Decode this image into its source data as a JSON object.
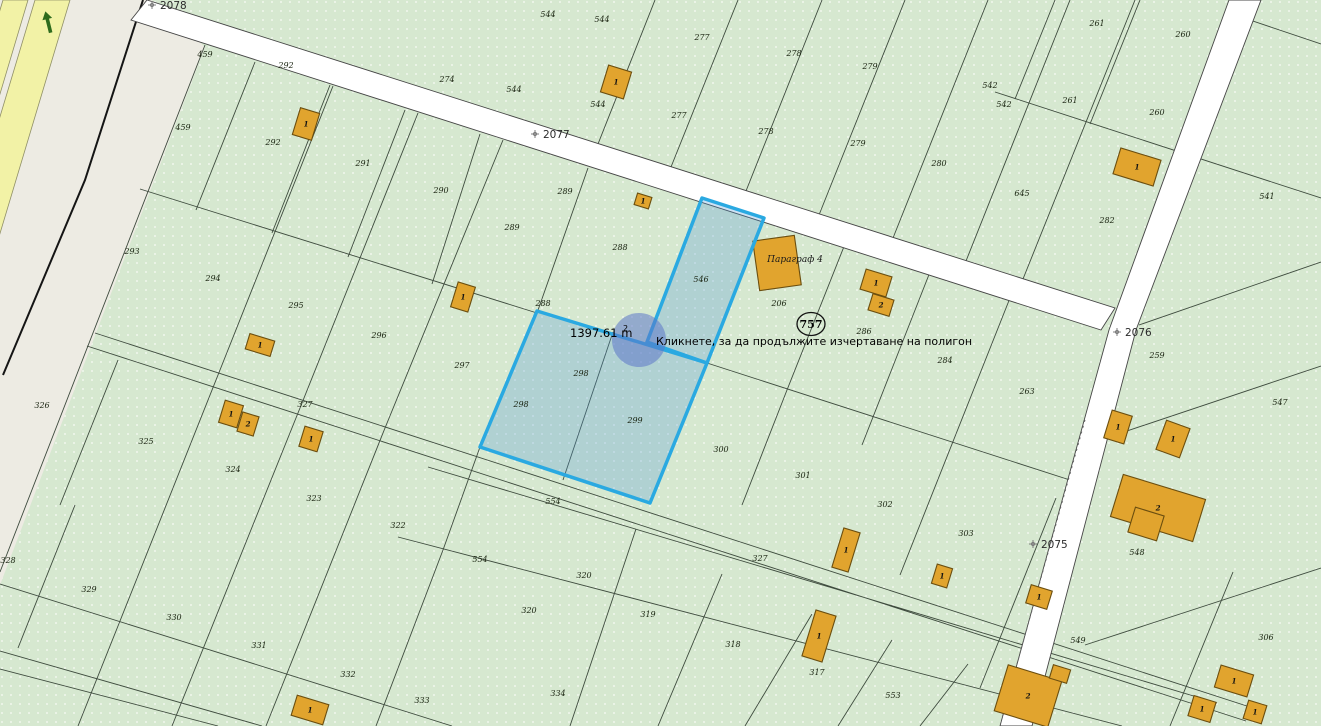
{
  "app": {
    "type": "cadastral-map-polygon-draw"
  },
  "map": {
    "area_text": "1397.61 m",
    "area_sup": "2",
    "tooltip": "Кликнете, за да продължите изчертаване на полигон",
    "circle_label": "757",
    "paragraph_label": "Параграф 4",
    "colors": {
      "green": "#d6e8d0",
      "beige": "#edebe3",
      "yellow": "#f2f2a6",
      "road_white": "#ffffff",
      "parcel_line": "#3e4b3e",
      "building_fill": "#e1a42e",
      "building_stroke": "#6b4e0f",
      "selection_stroke": "#2aa9e1",
      "selection_fill": "rgba(80,150,215,0.28)",
      "vertex_fill": "rgba(92,118,200,0.55)",
      "marker": "#7c7c7c",
      "arrow_green": "#2e6b1d"
    },
    "road_markers": [
      {
        "label": "2078",
        "cx": 152,
        "cy": 5,
        "lx": 160,
        "ly": 9
      },
      {
        "label": "2077",
        "cx": 535,
        "cy": 134,
        "lx": 543,
        "ly": 138
      },
      {
        "label": "2076",
        "cx": 1117,
        "cy": 332,
        "lx": 1125,
        "ly": 336
      },
      {
        "label": "2075",
        "cx": 1033,
        "cy": 544,
        "lx": 1041,
        "ly": 548
      }
    ],
    "parcel_labels": [
      {
        "t": "459",
        "x": 205,
        "y": 57
      },
      {
        "t": "459",
        "x": 183,
        "y": 130
      },
      {
        "t": "292",
        "x": 286,
        "y": 68
      },
      {
        "t": "292",
        "x": 273,
        "y": 145
      },
      {
        "t": "291",
        "x": 363,
        "y": 166
      },
      {
        "t": "290",
        "x": 441,
        "y": 193
      },
      {
        "t": "289",
        "x": 565,
        "y": 194
      },
      {
        "t": "289",
        "x": 512,
        "y": 230
      },
      {
        "t": "288",
        "x": 620,
        "y": 250
      },
      {
        "t": "288",
        "x": 543,
        "y": 306
      },
      {
        "t": "274",
        "x": 447,
        "y": 82
      },
      {
        "t": "544",
        "x": 548,
        "y": 17
      },
      {
        "t": "544",
        "x": 602,
        "y": 22
      },
      {
        "t": "544",
        "x": 514,
        "y": 92
      },
      {
        "t": "544",
        "x": 598,
        "y": 107
      },
      {
        "t": "277",
        "x": 702,
        "y": 40
      },
      {
        "t": "277",
        "x": 679,
        "y": 118
      },
      {
        "t": "278",
        "x": 794,
        "y": 56
      },
      {
        "t": "278",
        "x": 766,
        "y": 134
      },
      {
        "t": "279",
        "x": 870,
        "y": 69
      },
      {
        "t": "279",
        "x": 858,
        "y": 146
      },
      {
        "t": "280",
        "x": 939,
        "y": 166
      },
      {
        "t": "542",
        "x": 990,
        "y": 88
      },
      {
        "t": "542",
        "x": 1004,
        "y": 107
      },
      {
        "t": "261",
        "x": 1097,
        "y": 26
      },
      {
        "t": "261",
        "x": 1070,
        "y": 103
      },
      {
        "t": "260",
        "x": 1183,
        "y": 37
      },
      {
        "t": "260",
        "x": 1157,
        "y": 115
      },
      {
        "t": "645",
        "x": 1022,
        "y": 196
      },
      {
        "t": "282",
        "x": 1107,
        "y": 223
      },
      {
        "t": "541",
        "x": 1267,
        "y": 199
      },
      {
        "t": "546",
        "x": 701,
        "y": 282
      },
      {
        "t": "206",
        "x": 779,
        "y": 306
      },
      {
        "t": "286",
        "x": 864,
        "y": 334
      },
      {
        "t": "284",
        "x": 945,
        "y": 363
      },
      {
        "t": "263",
        "x": 1027,
        "y": 394
      },
      {
        "t": "259",
        "x": 1157,
        "y": 358
      },
      {
        "t": "547",
        "x": 1280,
        "y": 405
      },
      {
        "t": "293",
        "x": 132,
        "y": 254
      },
      {
        "t": "294",
        "x": 213,
        "y": 281
      },
      {
        "t": "295",
        "x": 296,
        "y": 308
      },
      {
        "t": "296",
        "x": 379,
        "y": 338
      },
      {
        "t": "297",
        "x": 462,
        "y": 368
      },
      {
        "t": "298",
        "x": 581,
        "y": 376
      },
      {
        "t": "298",
        "x": 521,
        "y": 407
      },
      {
        "t": "299",
        "x": 635,
        "y": 423
      },
      {
        "t": "300",
        "x": 721,
        "y": 452
      },
      {
        "t": "301",
        "x": 803,
        "y": 478
      },
      {
        "t": "302",
        "x": 885,
        "y": 507
      },
      {
        "t": "303",
        "x": 966,
        "y": 536
      },
      {
        "t": "327",
        "x": 305,
        "y": 407
      },
      {
        "t": "327",
        "x": 760,
        "y": 561
      },
      {
        "t": "326",
        "x": 42,
        "y": 408
      },
      {
        "t": "325",
        "x": 146,
        "y": 444
      },
      {
        "t": "324",
        "x": 233,
        "y": 472
      },
      {
        "t": "323",
        "x": 314,
        "y": 501
      },
      {
        "t": "322",
        "x": 398,
        "y": 528
      },
      {
        "t": "328",
        "x": 8,
        "y": 563
      },
      {
        "t": "329",
        "x": 89,
        "y": 592
      },
      {
        "t": "330",
        "x": 174,
        "y": 620
      },
      {
        "t": "331",
        "x": 259,
        "y": 648
      },
      {
        "t": "332",
        "x": 348,
        "y": 677
      },
      {
        "t": "333",
        "x": 422,
        "y": 703
      },
      {
        "t": "334",
        "x": 558,
        "y": 696
      },
      {
        "t": "554",
        "x": 553,
        "y": 504
      },
      {
        "t": "554",
        "x": 480,
        "y": 562
      },
      {
        "t": "320",
        "x": 584,
        "y": 578
      },
      {
        "t": "320",
        "x": 529,
        "y": 613
      },
      {
        "t": "319",
        "x": 648,
        "y": 617
      },
      {
        "t": "318",
        "x": 733,
        "y": 647
      },
      {
        "t": "317",
        "x": 817,
        "y": 675
      },
      {
        "t": "553",
        "x": 893,
        "y": 698
      },
      {
        "t": "548",
        "x": 1137,
        "y": 555
      },
      {
        "t": "549",
        "x": 1078,
        "y": 643
      },
      {
        "t": "306",
        "x": 1266,
        "y": 640
      }
    ],
    "buildings": [
      {
        "x": 306,
        "y": 124,
        "w": 20,
        "h": 28,
        "r": 17,
        "n": "1"
      },
      {
        "x": 616,
        "y": 82,
        "w": 24,
        "h": 28,
        "r": 17,
        "n": "1"
      },
      {
        "x": 643,
        "y": 201,
        "w": 15,
        "h": 12,
        "r": 17,
        "n": "1"
      },
      {
        "x": 463,
        "y": 297,
        "w": 18,
        "h": 26,
        "r": 17,
        "n": "1"
      },
      {
        "x": 260,
        "y": 345,
        "w": 26,
        "h": 16,
        "r": 17,
        "n": "1"
      },
      {
        "x": 231,
        "y": 414,
        "w": 19,
        "h": 23,
        "r": 17,
        "n": "1"
      },
      {
        "x": 248,
        "y": 424,
        "w": 17,
        "h": 20,
        "r": 17,
        "n": "2"
      },
      {
        "x": 311,
        "y": 439,
        "w": 19,
        "h": 21,
        "r": 17,
        "n": "1"
      },
      {
        "x": 1137,
        "y": 167,
        "w": 42,
        "h": 27,
        "r": 17,
        "n": "1"
      },
      {
        "x": 777,
        "y": 263,
        "w": 42,
        "h": 50,
        "r": -8,
        "n": ""
      },
      {
        "x": 876,
        "y": 283,
        "w": 27,
        "h": 21,
        "r": 17,
        "n": "1"
      },
      {
        "x": 881,
        "y": 305,
        "w": 22,
        "h": 17,
        "r": 17,
        "n": "2"
      },
      {
        "x": 1118,
        "y": 427,
        "w": 21,
        "h": 29,
        "r": 17,
        "n": "1"
      },
      {
        "x": 1173,
        "y": 439,
        "w": 25,
        "h": 31,
        "r": 20,
        "n": "1"
      },
      {
        "x": 1158,
        "y": 508,
        "w": 86,
        "h": 44,
        "r": 17,
        "n": "2"
      },
      {
        "x": 1146,
        "y": 524,
        "w": 30,
        "h": 26,
        "r": 17,
        "n": ""
      },
      {
        "x": 846,
        "y": 550,
        "w": 17,
        "h": 41,
        "r": 17,
        "n": "1"
      },
      {
        "x": 942,
        "y": 576,
        "w": 16,
        "h": 20,
        "r": 17,
        "n": "1"
      },
      {
        "x": 1039,
        "y": 597,
        "w": 22,
        "h": 19,
        "r": 17,
        "n": "1"
      },
      {
        "x": 819,
        "y": 636,
        "w": 21,
        "h": 48,
        "r": 17,
        "n": "1"
      },
      {
        "x": 1234,
        "y": 681,
        "w": 34,
        "h": 23,
        "r": 17,
        "n": "1"
      },
      {
        "x": 1202,
        "y": 709,
        "w": 23,
        "h": 21,
        "r": 17,
        "n": "1"
      },
      {
        "x": 1255,
        "y": 712,
        "w": 19,
        "h": 19,
        "r": 17,
        "n": "1"
      },
      {
        "x": 1028,
        "y": 696,
        "w": 56,
        "h": 48,
        "r": 17,
        "n": "2"
      },
      {
        "x": 1060,
        "y": 674,
        "w": 18,
        "h": 14,
        "r": 17,
        "n": ""
      },
      {
        "x": 310,
        "y": 710,
        "w": 33,
        "h": 21,
        "r": 17,
        "n": "1"
      }
    ]
  }
}
